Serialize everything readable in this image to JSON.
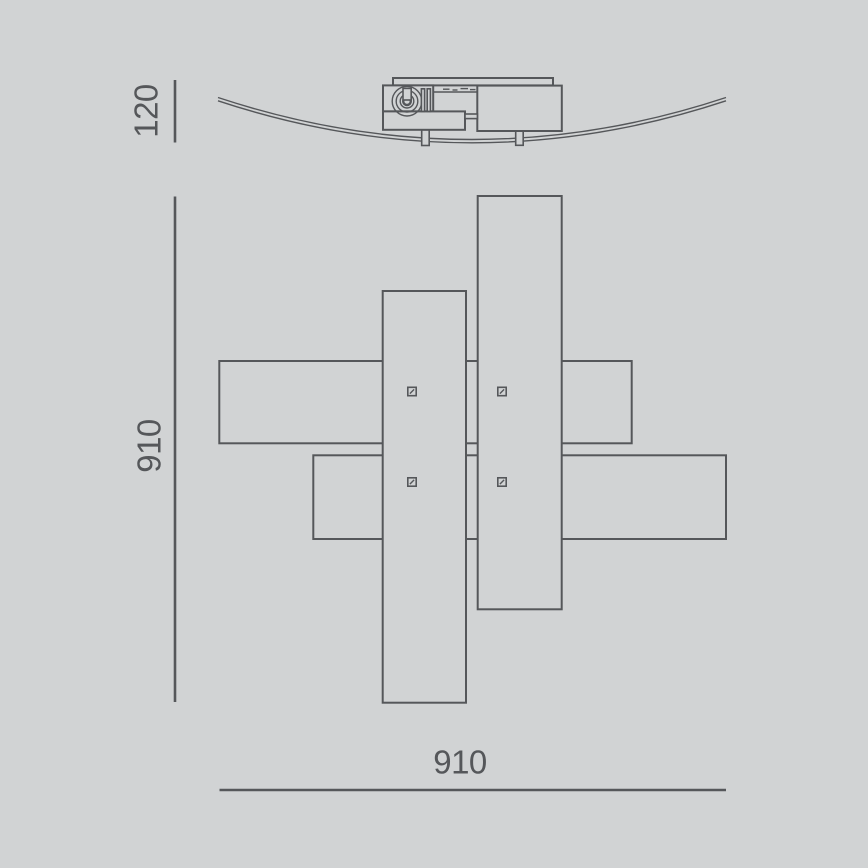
{
  "drawing": {
    "colors": {
      "background": "#d1d3d4",
      "line": "#55575a"
    },
    "side_view": {
      "height_dimension": "120"
    },
    "plan_view": {
      "vertical_dimension": "910",
      "horizontal_dimension": "910"
    }
  }
}
